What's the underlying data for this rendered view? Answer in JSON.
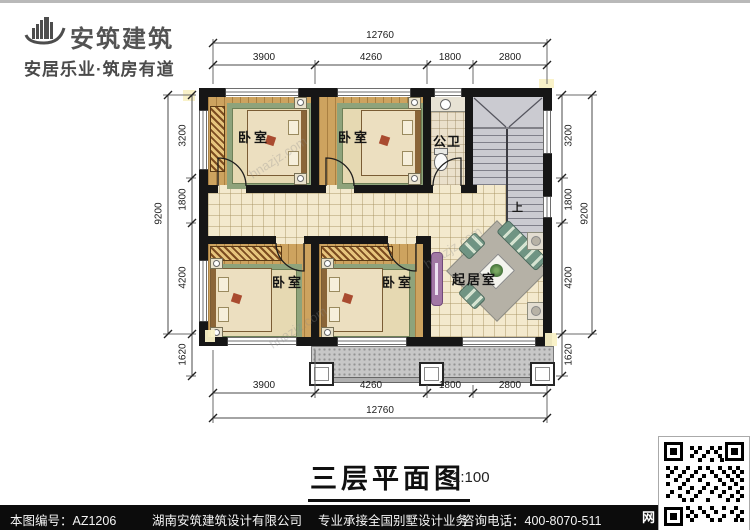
{
  "logo": {
    "name": "安筑建筑",
    "tagline": "安居乐业·筑房有道"
  },
  "plan": {
    "title": "三层平面图",
    "scale": "1:100",
    "rooms": {
      "bedroom": "卧室",
      "bathroom": "公卫",
      "living": "起居室",
      "stair_up": "上"
    },
    "dims": {
      "h_total": "12760",
      "h_segments": [
        "3900",
        "4260",
        "1800",
        "2800"
      ],
      "v_total": "9200",
      "v_segments": [
        "3200",
        "1800",
        "4200"
      ],
      "v_extra": "1620"
    }
  },
  "watermark": "hnazjz.com",
  "footer": {
    "drawing_no": "本图编号：AZ1206",
    "company": "湖南安筑建筑设计有限公司",
    "service": "专业承接全国别墅设计业务",
    "phone": "咨询电话：400-8070-511",
    "web": "网"
  },
  "colors": {
    "wall": "#161616",
    "wood_floor": "#cda35f",
    "tile_floor": "#f3e9cd",
    "stair": "#cbcbd1",
    "accent_red": "#a94b2f",
    "sofa_green": "#6f9483",
    "tv_cabinet_purple": "#a277a5"
  }
}
